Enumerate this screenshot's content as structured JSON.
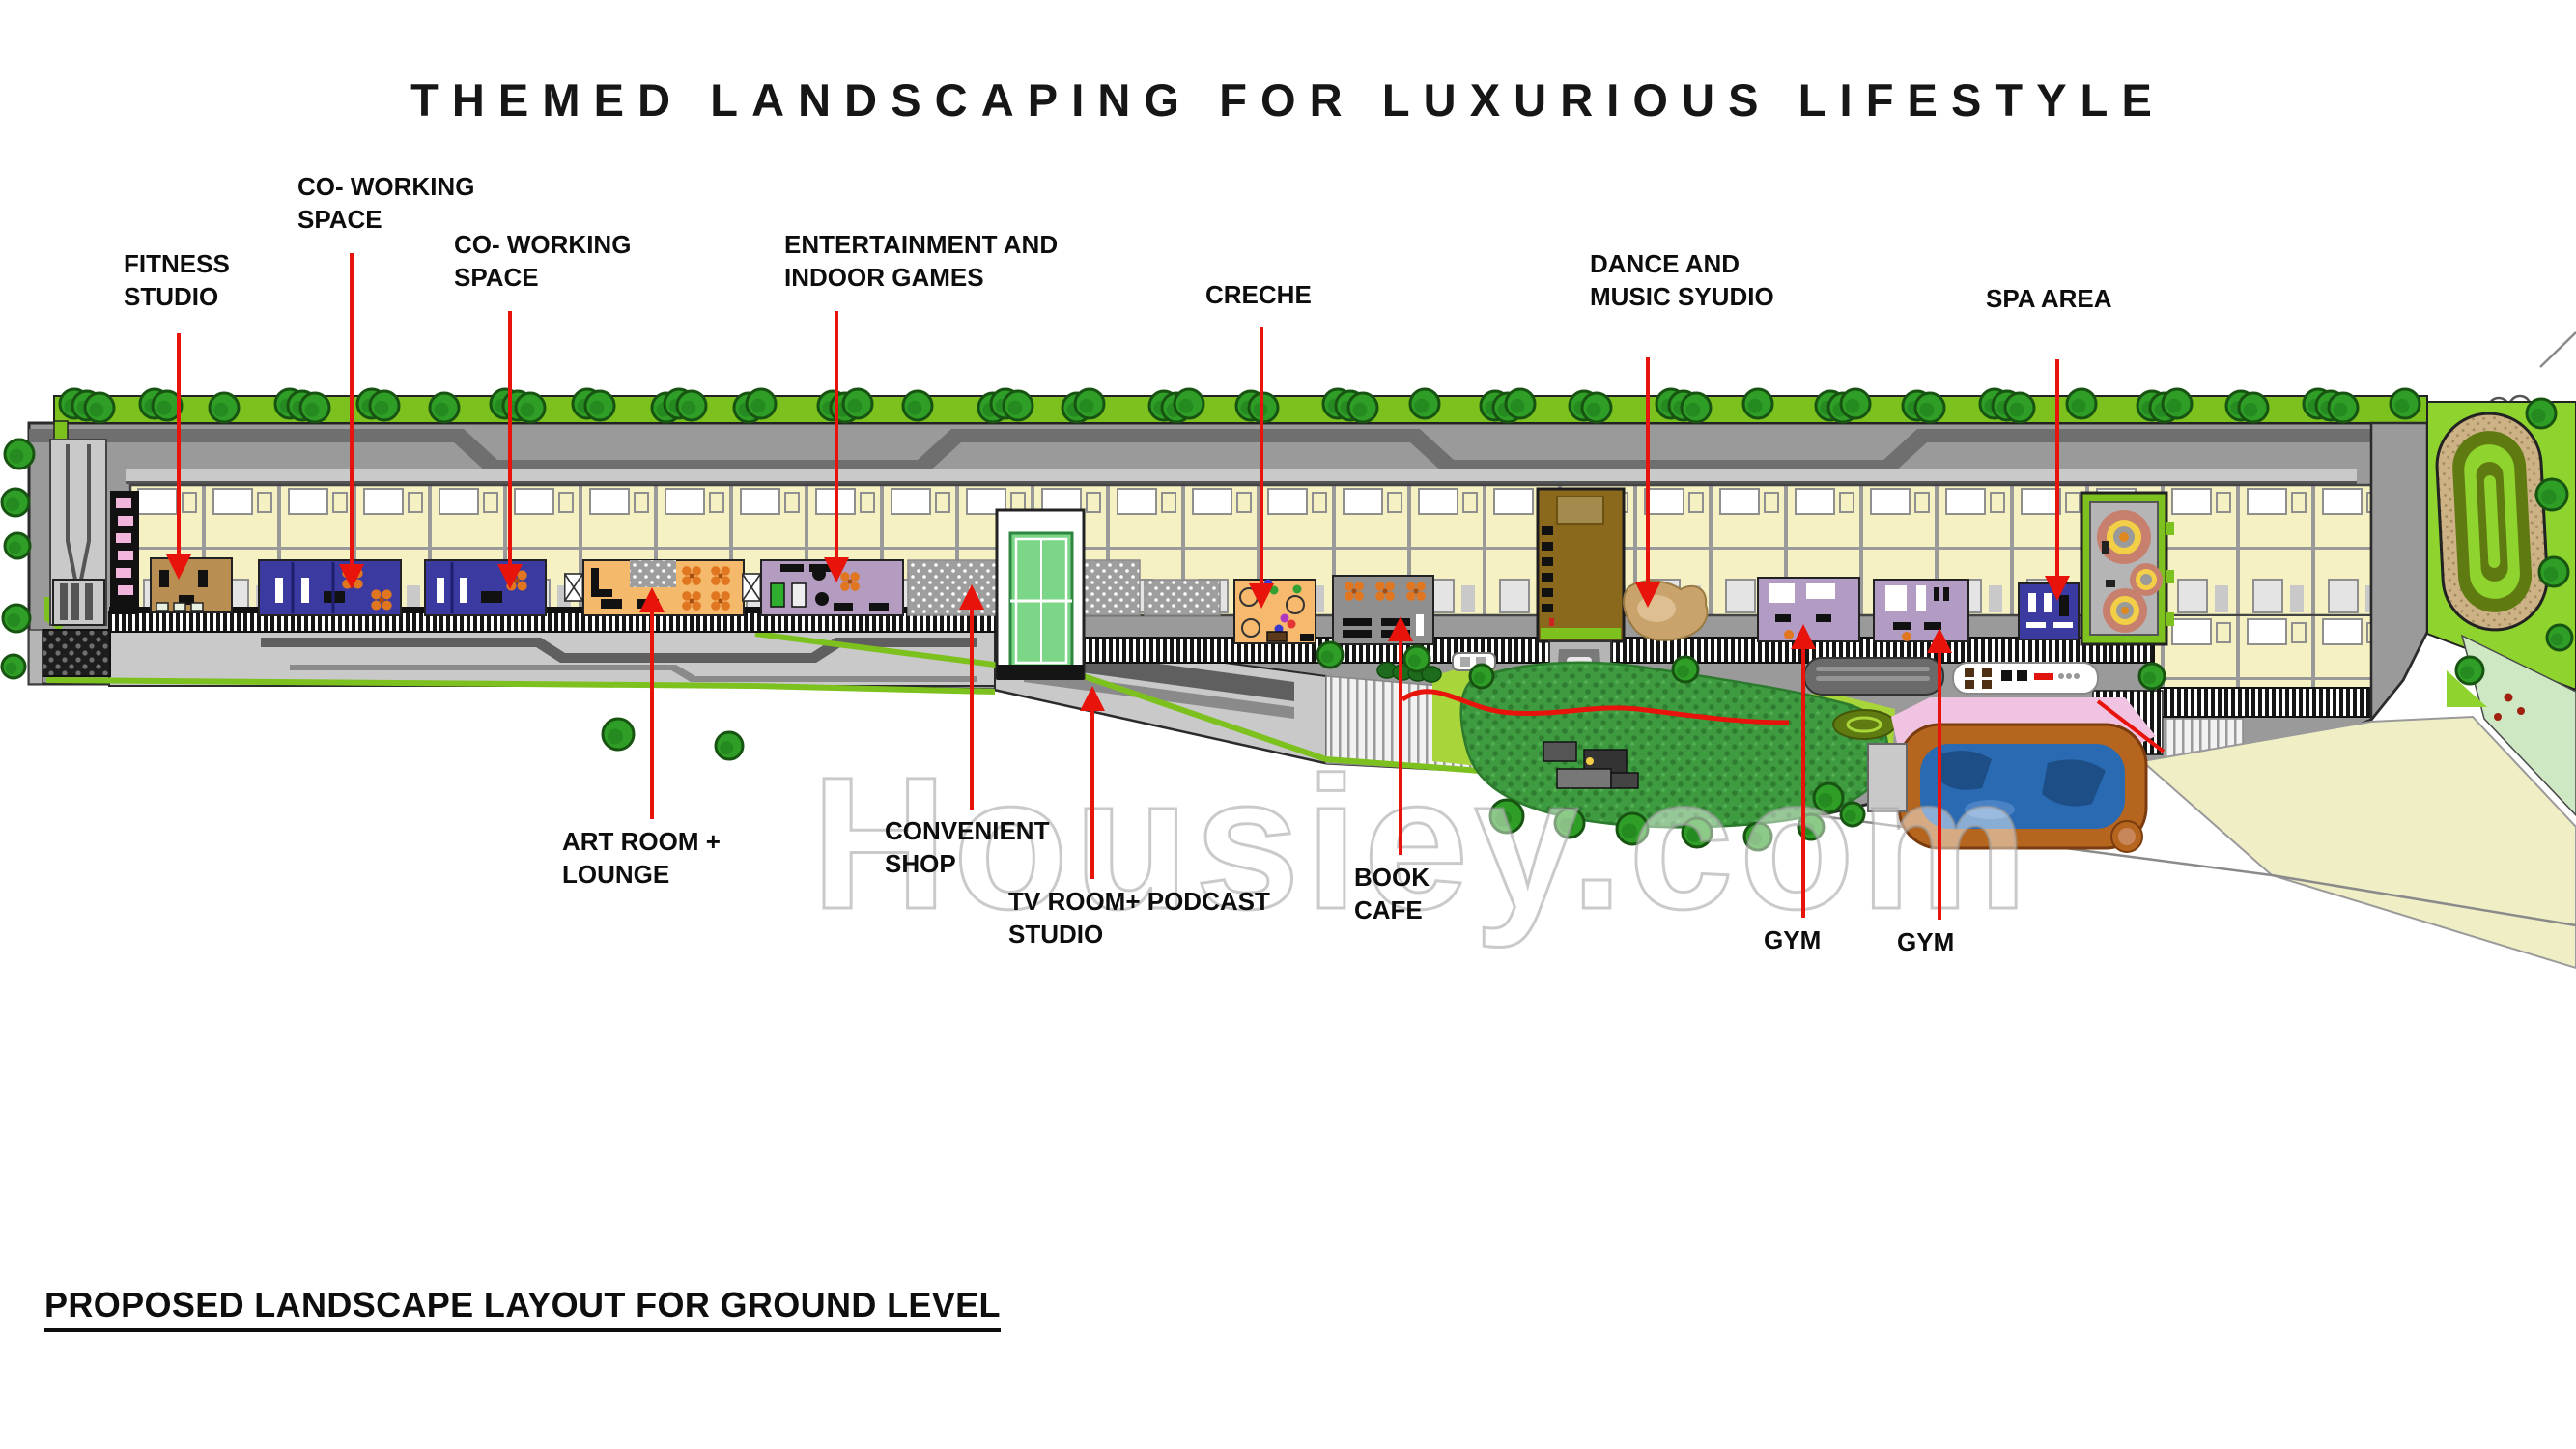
{
  "title": "THEMED LANDSCAPING FOR LUXURIOUS LIFESTYLE",
  "footer_heading": "PROPOSED LANDSCAPE LAYOUT FOR GROUND LEVEL",
  "watermark": "Housiey.com",
  "labels": {
    "fitness_studio": {
      "line1": "FITNESS",
      "line2": "STUDIO"
    },
    "coworking_space_1": {
      "line1": "CO- WORKING",
      "line2": "SPACE"
    },
    "coworking_space_2": {
      "line1": "CO- WORKING",
      "line2": "SPACE"
    },
    "entertainment_games": {
      "line1": "ENTERTAINMENT AND",
      "line2": "INDOOR GAMES"
    },
    "creche": {
      "line1": "CRECHE",
      "line2": ""
    },
    "dance_music_studio": {
      "line1": "DANCE AND",
      "line2": "MUSIC SYUDIO"
    },
    "spa_area": {
      "line1": "SPA AREA",
      "line2": ""
    },
    "art_room_lounge": {
      "line1": "ART ROOM +",
      "line2": "LOUNGE"
    },
    "convenient_shop": {
      "line1": "CONVENIENT",
      "line2": "SHOP"
    },
    "tv_room_podcast": {
      "line1": "TV ROOM+ PODCAST",
      "line2": "STUDIO"
    },
    "book_cafe": {
      "line1": "BOOK",
      "line2": "CAFE"
    },
    "gym_1": {
      "line1": "GYM",
      "line2": ""
    },
    "gym_2": {
      "line1": "GYM",
      "line2": ""
    }
  },
  "colors": {
    "arrow_red": "#e8140c",
    "green_strip": "#7dc11e",
    "lawn_bright": "#8fd32e",
    "lawn_dark": "#3f9b40",
    "plate_yellow": "#f5f1c2",
    "gray_light": "#c9c9c9",
    "gray_mid": "#9a9a9a",
    "gray_dark": "#6f6f6f",
    "coworking_blue": "#3a3aa0",
    "fitness_tan": "#b98e52",
    "art_orange": "#f5b96b",
    "entertainment_purple": "#b39cc0",
    "creche_orange": "#f6b96e",
    "gym_purple": "#b39cc4",
    "lobby_brown": "#8a691c",
    "pool_blue": "#2a6ab2",
    "pool_border": "#b5651d",
    "deck_pink": "#efc3e1",
    "track_sand": "#cdb285",
    "track_olive": "#5f7a10",
    "pale_plot": "#f0eec5"
  }
}
